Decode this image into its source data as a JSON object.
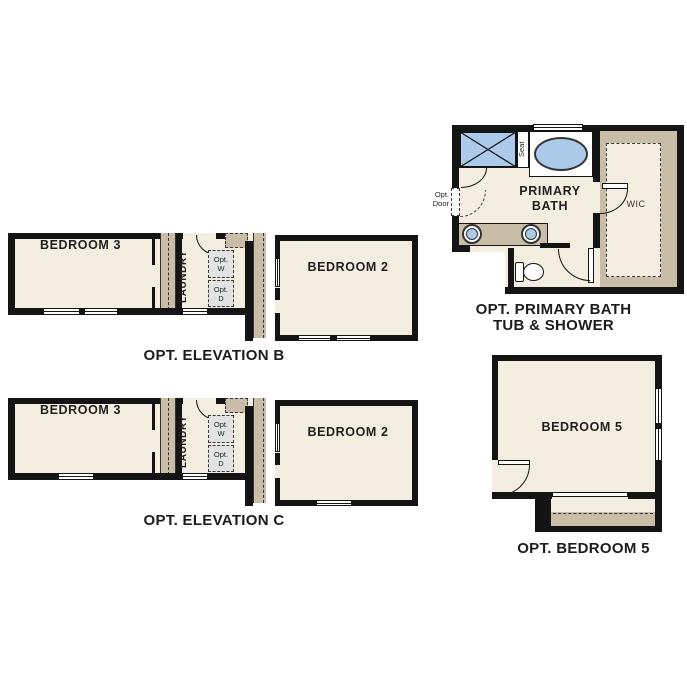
{
  "colors": {
    "wall": "#141414",
    "room_fill": "#f4eee1",
    "cabinet_tan": "#c9bda8",
    "fixture_blue": "#abc9e8",
    "appliance_gray": "#e2e4e4",
    "label_text": "#1c1c1c"
  },
  "elevation_b": {
    "caption": "OPT. ELEVATION B",
    "bedroom3": "BEDROOM 3",
    "bedroom2": "BEDROOM 2",
    "laundry": "LAUNDRY",
    "washer": {
      "l1": "Opt.",
      "l2": "W"
    },
    "dryer": {
      "l1": "Opt.",
      "l2": "D"
    }
  },
  "elevation_c": {
    "caption": "OPT. ELEVATION C",
    "bedroom3": "BEDROOM 3",
    "bedroom2": "BEDROOM 2",
    "laundry": "LAUNDRY",
    "washer": {
      "l1": "Opt.",
      "l2": "W"
    },
    "dryer": {
      "l1": "Opt.",
      "l2": "D"
    }
  },
  "primary_bath": {
    "caption_l1": "OPT. PRIMARY BATH",
    "caption_l2": "TUB & SHOWER",
    "room_l1": "PRIMARY",
    "room_l2": "BATH",
    "wic": "WIC",
    "seat": "Seat",
    "opt_door_l1": "Opt.",
    "opt_door_l2": "Door"
  },
  "bedroom5": {
    "caption": "OPT. BEDROOM 5",
    "room": "BEDROOM 5"
  }
}
